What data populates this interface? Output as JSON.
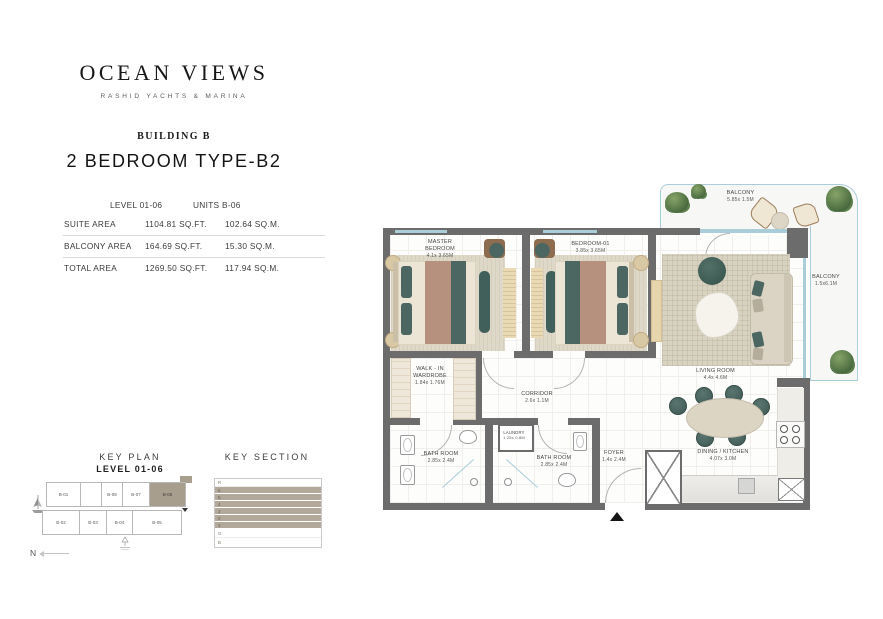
{
  "header": {
    "brand": "OCEAN VIEWS",
    "brand_subtitle": "RASHID YACHTS & MARINA",
    "building": "BUILDING B",
    "unit_title": "2 BEDROOM TYPE-B2"
  },
  "area_table": {
    "level": "LEVEL 01-06",
    "units": "UNITS B-06",
    "rows": [
      {
        "label": "SUITE AREA",
        "sqft": "1104.81 SQ.FT.",
        "sqm": "102.64 SQ.M."
      },
      {
        "label": "BALCONY AREA",
        "sqft": "164.69 SQ.FT.",
        "sqm": "15.30 SQ.M."
      },
      {
        "label": "TOTAL AREA",
        "sqft": "1269.50 SQ.FT.",
        "sqm": "117.94 SQ.M."
      }
    ]
  },
  "floorplan": {
    "rooms": {
      "master_bedroom": {
        "name": "MASTER BEDROOM",
        "dims": "4.1x 3.65M"
      },
      "bedroom_01": {
        "name": "BEDROOM-01",
        "dims": "3.85x 3.65M"
      },
      "living_room": {
        "name": "LIVING ROOM",
        "dims": "4.4x 4.6M"
      },
      "walk_in_wardrobe": {
        "name": "WALK - IN WARDROBE",
        "dims": "1.84x 1.76M"
      },
      "corridor": {
        "name": "CORRIDOR",
        "dims": "2.6x 1.1M"
      },
      "laundry": {
        "name": "LAUNDRY",
        "dims": "1.25x 0.8M"
      },
      "bathroom_master": {
        "name": "BATH ROOM",
        "dims": "2.85x 2.4M"
      },
      "bathroom_2": {
        "name": "BATH ROOM",
        "dims": "2.85x 2.4M"
      },
      "foyer": {
        "name": "FOYER",
        "dims": "1.4x 2.4M"
      },
      "dining_kitchen": {
        "name": "DINING / KITCHEN",
        "dims": "4.07x 3.0M"
      },
      "balcony_top": {
        "name": "BALCONY",
        "dims": "5.85x 1.5M"
      },
      "balcony_right": {
        "name": "BALCONY",
        "dims": "1.5x6.1M"
      }
    }
  },
  "key_plan": {
    "title": "KEY PLAN",
    "subtitle": "LEVEL 01-06",
    "north_label": "N",
    "top_units": [
      "B-01",
      "B-08",
      "B-07",
      "B-06"
    ],
    "bottom_units": [
      "B-02",
      "B-03",
      "B-04",
      "B-05"
    ],
    "highlighted_unit": "B-06"
  },
  "key_section": {
    "title": "KEY SECTION",
    "floors": [
      "R",
      "6",
      "5",
      "4",
      "3",
      "2",
      "1",
      "G",
      "B"
    ]
  },
  "colors": {
    "wall": "#6c6c6c",
    "glazing": "#a9cdd9",
    "highlight": "#a89e8e",
    "section_fill": "#b2a99b",
    "teal": "#4c6661",
    "blanket": "#b5917e",
    "wood": "#d9c8a4"
  }
}
